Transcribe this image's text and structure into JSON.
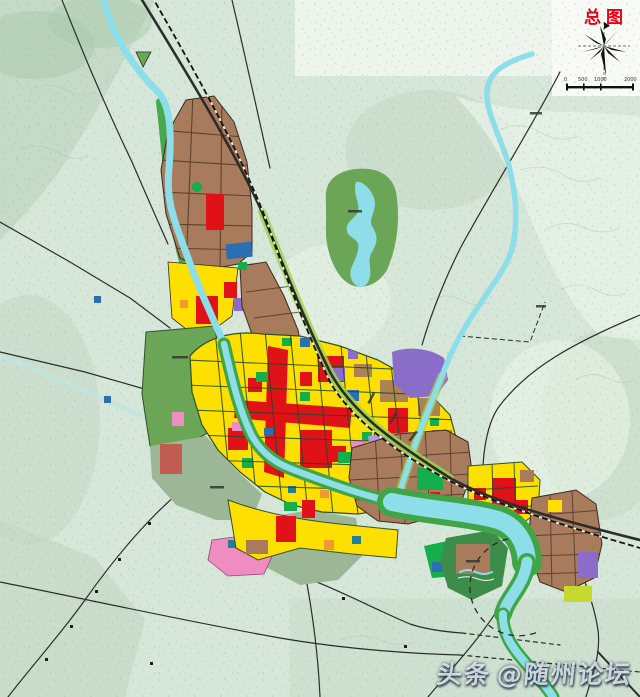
{
  "header": {
    "title": "总图"
  },
  "compass": {
    "label": "north-compass-rose"
  },
  "scalebar": {
    "ticks": [
      "0",
      "500",
      "1000",
      "2000"
    ]
  },
  "watermark": {
    "prefix": "头条",
    "suffix": "@随州论坛"
  },
  "map": {
    "type": "urban-master-plan-map",
    "features": {
      "rivers": [
        "main-river-north-south",
        "east-tributary",
        "west-stream",
        "wide-lower-river-bend"
      ],
      "parks": [
        "north-lake-park",
        "west-forest-park",
        "southeast-riverside-park"
      ],
      "districts": [
        "north-industrial-brown",
        "central-mixed-yellow-red",
        "southeast-brown-grid",
        "far-east-cluster",
        "bottom-right-brown-grid"
      ],
      "transport": [
        "northeast-southwest-corridor-road",
        "railway-line",
        "rural-roads",
        "dashed-planning-boundary"
      ]
    }
  },
  "palette": {
    "base": "#d6e6d8",
    "hill": "#c1d7c3",
    "hillDark": "#a9c9ab",
    "pale": "#e9f3e8",
    "notch": "#edf5ec",
    "corner": "#f7faf5",
    "water": "#8edee9",
    "waterFaint": "#bfe5e0",
    "bankGreen": "#3fa546",
    "bankLight": "#9fd44d",
    "parkMid": "#6ba556",
    "parkDark": "#3e8c49",
    "parkBright": "#14ae4b",
    "greyGreen": "#9cb795",
    "brown": "#a87b5c",
    "yellow": "#fee000",
    "red": "#e01217",
    "purple": "#8a6cc9",
    "lavender": "#b19ae0",
    "pink": "#ef8cc2",
    "blue": "#2b6fb3",
    "teal": "#1f7f93",
    "orange": "#f0992d",
    "chartreuse": "#c6d92f",
    "road": "#2c2c2c",
    "gridRoad": "#1e4a2c",
    "rail": "#141414",
    "contour": "#aec6ad",
    "boundary": "#2a2a2a",
    "titleRed": "#e60012"
  }
}
